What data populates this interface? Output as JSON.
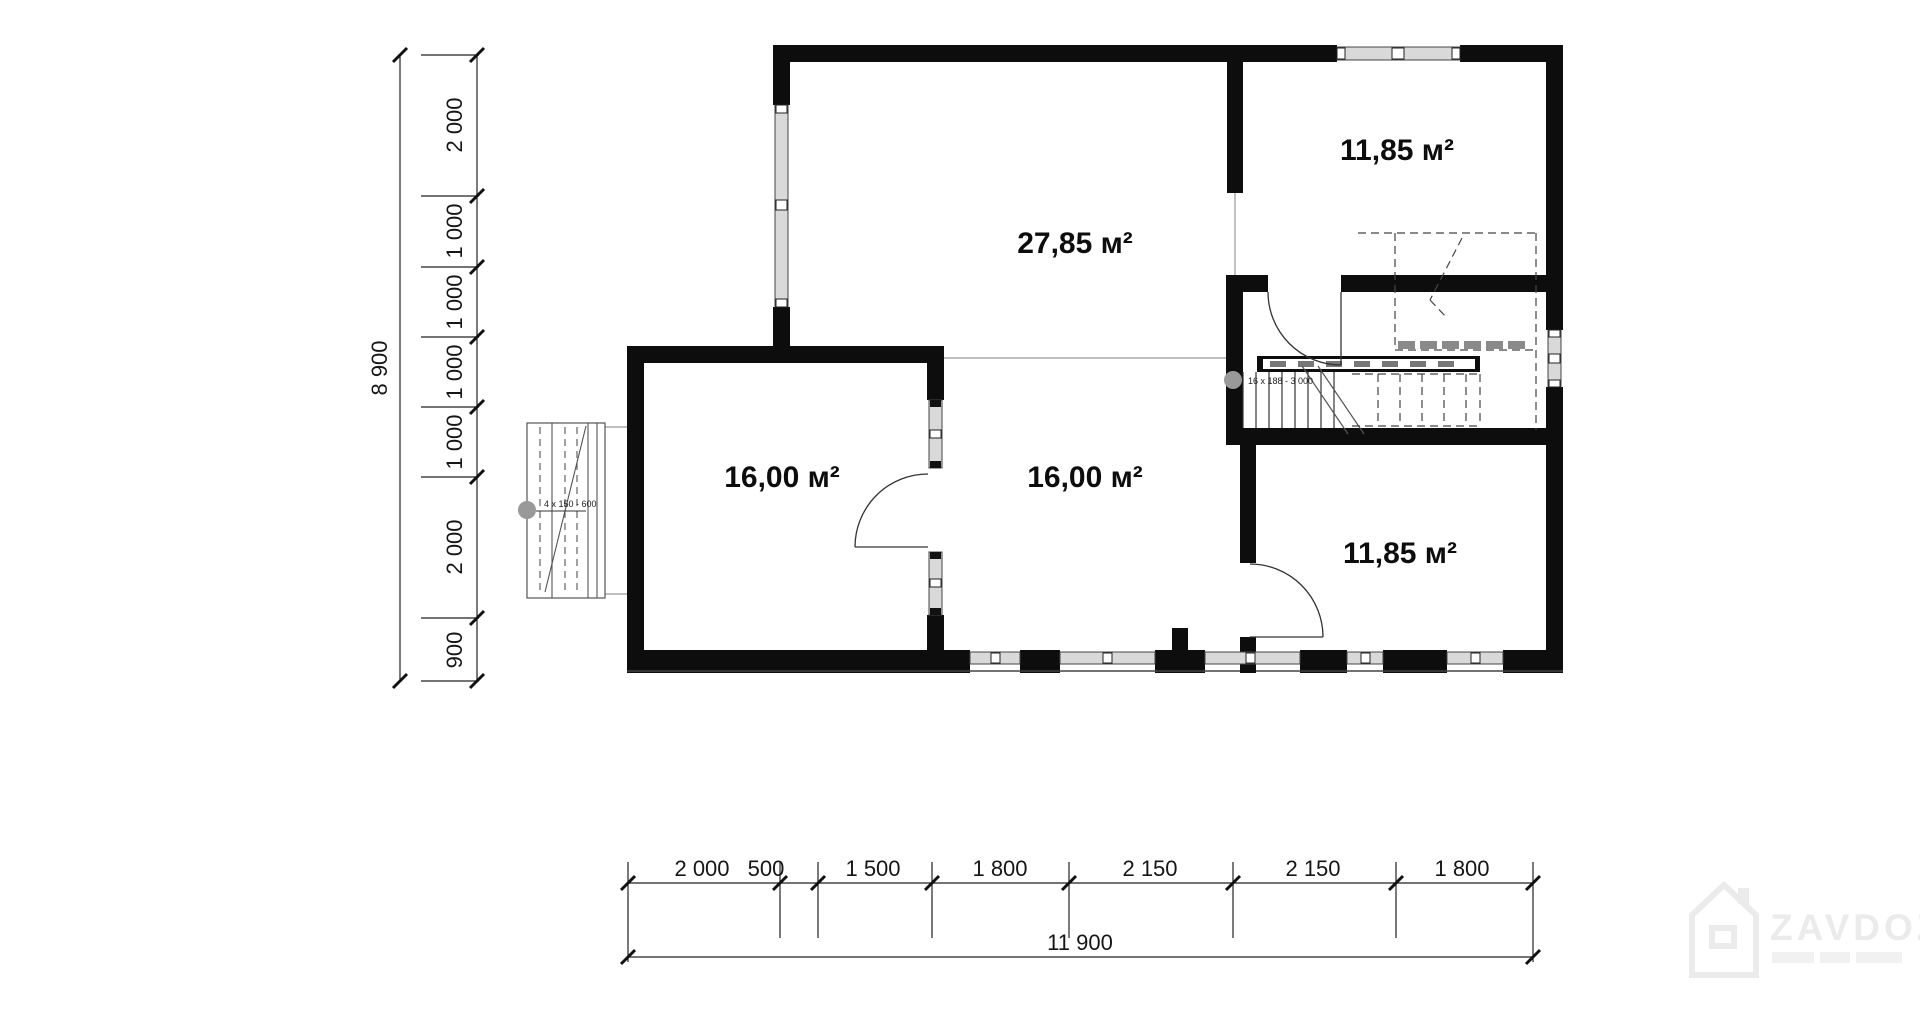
{
  "rooms": [
    {
      "id": "living",
      "label": "27,85 м²"
    },
    {
      "id": "room-top-right",
      "label": "11,85 м²"
    },
    {
      "id": "room-left",
      "label": "16,00 м²"
    },
    {
      "id": "room-middle",
      "label": "16,00 м²"
    },
    {
      "id": "room-bot-right",
      "label": "11,85 м²"
    }
  ],
  "annotations": {
    "stair": "16 x 188 - 3 000",
    "porch": "4 x 150 - 600"
  },
  "dimensions": {
    "left": {
      "segments": [
        "2 000",
        "1 000",
        "1 000",
        "1 000",
        "1 000",
        "2 000",
        "900"
      ],
      "total": "8 900"
    },
    "bottom": {
      "segments": [
        "2 000",
        "500",
        "1 500",
        "1 800",
        "2 150",
        "2 150",
        "1 800"
      ],
      "total": "11 900"
    }
  },
  "watermark": {
    "brand": "ZAVDOZ"
  },
  "colors": {
    "wall": "#0d0d0d",
    "line": "#333333",
    "thin": "#999999",
    "glass": "#d9d9d9",
    "watermark": "#ebebeb"
  }
}
